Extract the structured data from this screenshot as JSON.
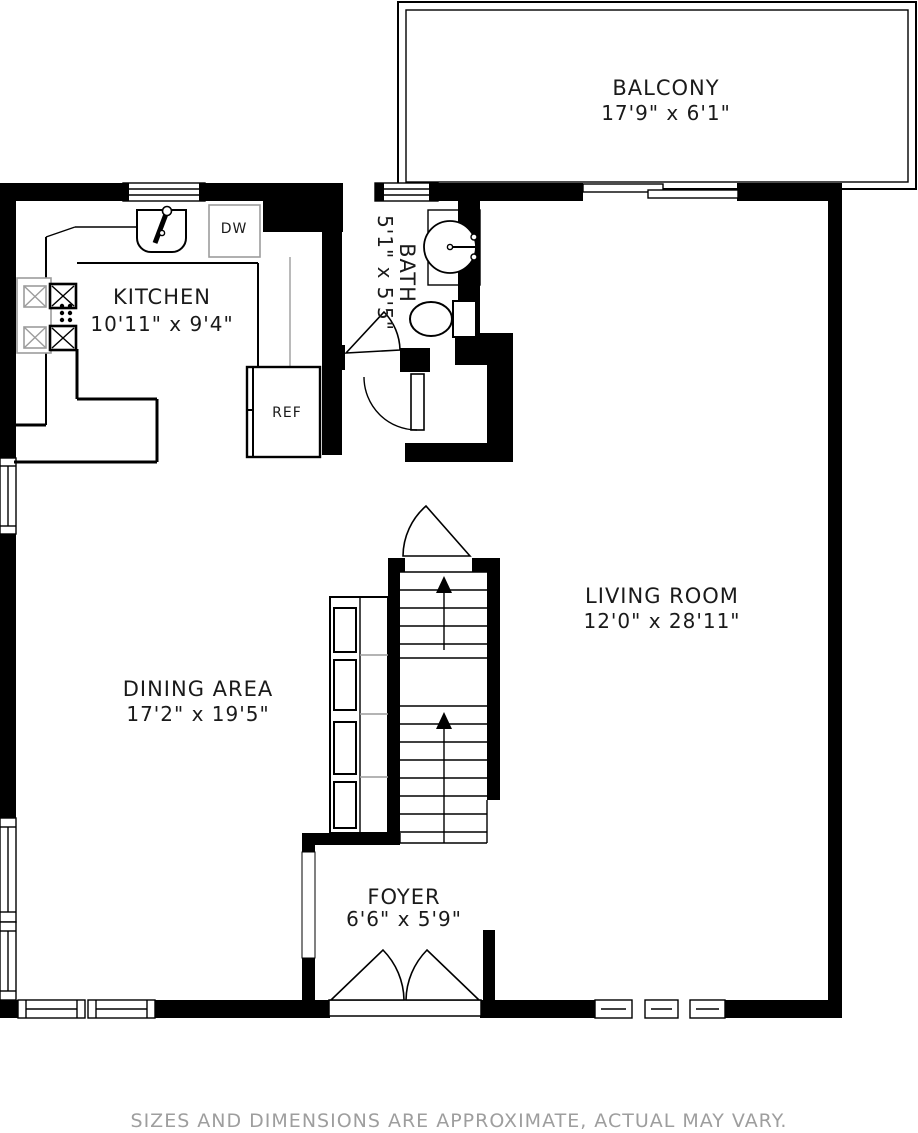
{
  "rooms": {
    "balcony": {
      "name": "BALCONY",
      "dims": "17'9\" x 6'1\""
    },
    "kitchen": {
      "name": "KITCHEN",
      "dims": "10'11\" x 9'4\""
    },
    "bath": {
      "name": "BATH",
      "dims": "5'1\" x 5'5\""
    },
    "living_room": {
      "name": "LIVING ROOM",
      "dims": "12'0\" x 28'11\""
    },
    "dining_area": {
      "name": "DINING AREA",
      "dims": "17'2\" x 19'5\""
    },
    "foyer": {
      "name": "FOYER",
      "dims": "6'6\" x 5'9\""
    }
  },
  "appliances": {
    "refrigerator_label": "REF",
    "dishwasher_label": "DW"
  },
  "disclaimer": "SIZES AND DIMENSIONS ARE APPROXIMATE, ACTUAL MAY VARY.",
  "colors": {
    "wall": "#000000",
    "background": "#ffffff",
    "disclaimer_text": "#9e9e9e",
    "fixture_gray": "#9c9c9c"
  }
}
